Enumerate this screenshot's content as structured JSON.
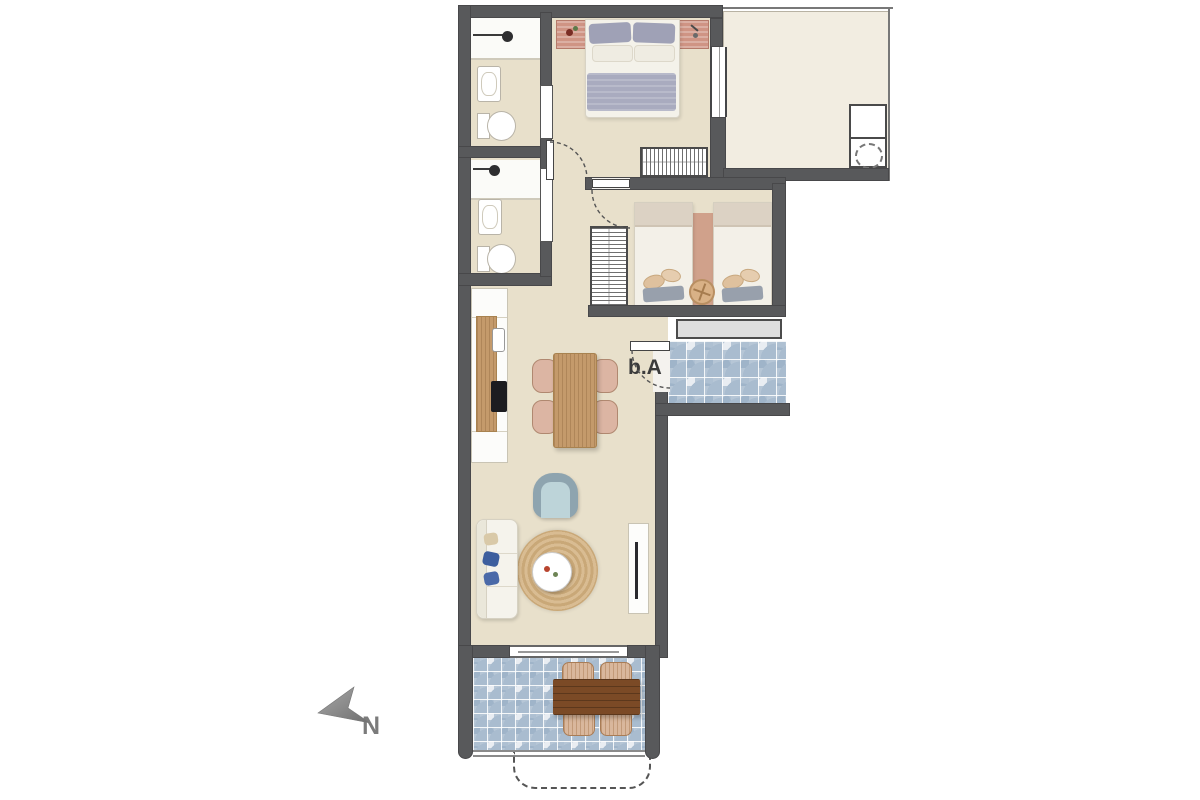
{
  "labels": {
    "door": "b.A",
    "north": "N"
  },
  "colors": {
    "wall": "#58595b",
    "interior_floor": "#e8e0cb",
    "terrace_floor": "#f2ede1",
    "tile_blue": "#a9bccf",
    "kitchen_wood": "#c49a6b",
    "outdoor_table_wood": "#7b4a26",
    "cooktop_black": "#1c1c20",
    "sofa_pillow_blue": "#3d5e9e",
    "armchair_seat_blue": "#bdd4d9",
    "rug_jute": "#d3b083",
    "bed_blanket_gray": "#a9abbf",
    "nightstand_pink": "#cf9484",
    "window_band_gray": "#dedede"
  }
}
